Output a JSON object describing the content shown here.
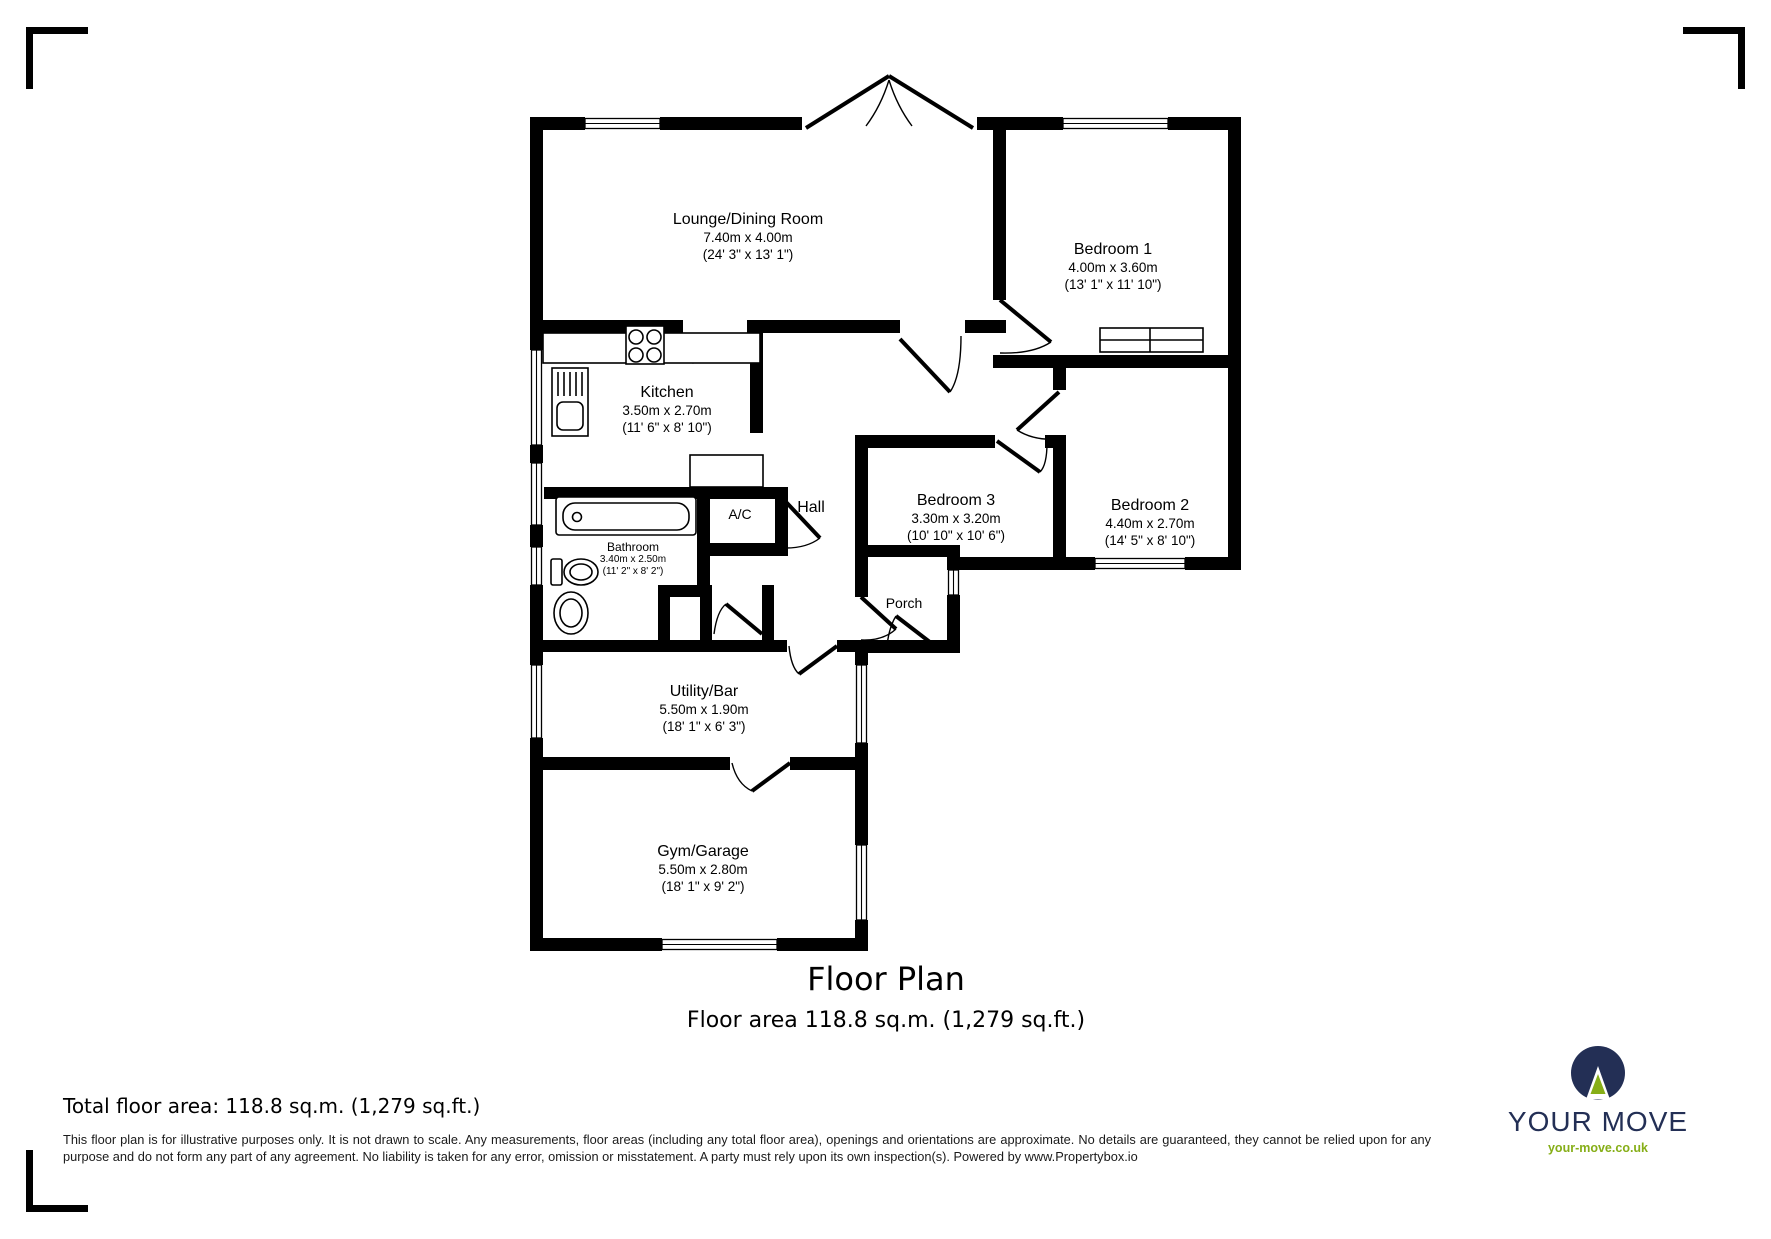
{
  "plan": {
    "title": "Floor Plan",
    "subtitle": "Floor area 118.8 sq.m. (1,279 sq.ft.)",
    "rooms": {
      "lounge": {
        "name": "Lounge/Dining Room",
        "metric": "7.40m x 4.00m",
        "imperial": "(24' 3\" x 13' 1\")"
      },
      "bedroom1": {
        "name": "Bedroom 1",
        "metric": "4.00m x 3.60m",
        "imperial": "(13' 1\" x 11' 10\")"
      },
      "kitchen": {
        "name": "Kitchen",
        "metric": "3.50m x 2.70m",
        "imperial": "(11' 6\" x 8' 10\")"
      },
      "hall": {
        "name": "Hall"
      },
      "ac": {
        "name": "A/C"
      },
      "bedroom3": {
        "name": "Bedroom 3",
        "metric": "3.30m x 3.20m",
        "imperial": "(10' 10\" x 10' 6\")"
      },
      "bedroom2": {
        "name": "Bedroom 2",
        "metric": "4.40m x 2.70m",
        "imperial": "(14' 5\" x 8' 10\")"
      },
      "bathroom": {
        "name": "Bathroom",
        "metric": "3.40m x 2.50m",
        "imperial": "(11' 2\" x 8' 2\")"
      },
      "porch": {
        "name": "Porch"
      },
      "utility": {
        "name": "Utility/Bar",
        "metric": "5.50m x 1.90m",
        "imperial": "(18' 1\" x 6' 3\")"
      },
      "gym": {
        "name": "Gym/Garage",
        "metric": "5.50m x 2.80m",
        "imperial": "(18' 1\" x 9' 2\")"
      }
    }
  },
  "footer": {
    "total_area": "Total floor area: 118.8 sq.m. (1,279 sq.ft.)",
    "disclaimer": "This floor plan is for illustrative purposes only. It is not drawn to scale. Any measurements, floor areas (including any total floor area), openings and orientations are approximate. No details are guaranteed, they cannot be relied upon for any purpose and do not form any part of any agreement. No liability is taken for any error, omission or misstatement. A party must rely upon its own inspection(s). Powered by www.Propertybox.io"
  },
  "brand": {
    "name": "YOUR MOVE",
    "url": "your-move.co.uk",
    "navy": "#232f55",
    "green": "#86ae17"
  }
}
